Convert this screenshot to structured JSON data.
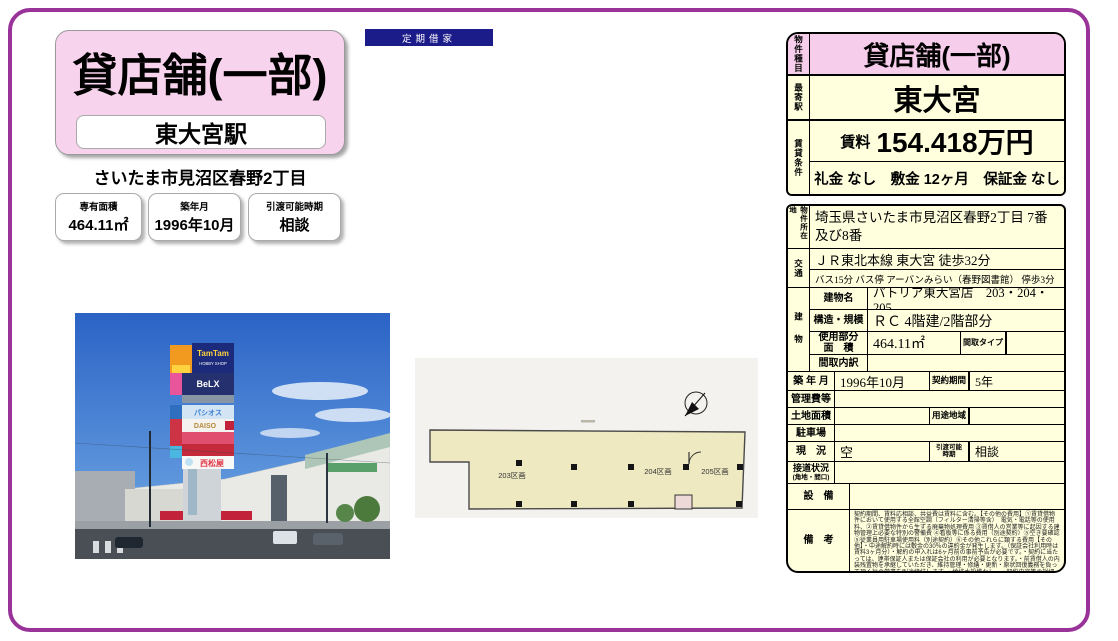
{
  "badge": {
    "label": "定期借家"
  },
  "title_card": {
    "title": "貸店舗(一部)",
    "station": "東大宮駅",
    "address": "さいたま市見沼区春野2丁目"
  },
  "info_boxes": {
    "area_label": "専有面積",
    "area_value": "464.11㎡",
    "built_label": "築年月",
    "built_value": "1996年10月",
    "delivery_label": "引渡可能時期",
    "delivery_value": "相談"
  },
  "photo_signs": {
    "tamtam": "TamTam",
    "hobby": "HOBBY SHOP",
    "belx": "BeLX",
    "pasios": "パシオス",
    "daiso": "DAISO",
    "nishimatsuya": "西松屋"
  },
  "floor_plan": {
    "unit_203": "203区画",
    "unit_204": "204区画",
    "unit_205": "205区画"
  },
  "summary": {
    "type_label": "物件種目",
    "type_value": "貸店舗(一部)",
    "station_label": "最寄駅",
    "station_value": "東大宮",
    "terms_label": "賃貸条件",
    "rent_label": "賃料",
    "rent_value": "154.418万円",
    "fees": "礼金 なし　敷金 12ヶ月　保証金 なし"
  },
  "details": {
    "location_label": "物件所在地",
    "location_value": "埼玉県さいたま市見沼区春野2丁目 7番及び8番",
    "access_label": "交通",
    "access_line1": "ＪＲ東北本線 東大宮 徒歩32分",
    "access_line2": "バス15分 バス停 アーバンみらい（春野図書館） 停歩3分",
    "building_label": "建物",
    "building_name_label": "建物名",
    "building_name_value": "パトリア東大宮店　203・204・205",
    "structure_label": "構造・規模",
    "structure_value": "ＲＣ 4階建/2階部分",
    "used_area_label1": "使用部分",
    "used_area_label2": "面　積",
    "used_area_value": "464.11㎡",
    "madori_type_label": "間取タイプ",
    "madori_detail_label": "間取内訳",
    "built_label": "築 年 月",
    "built_value": "1996年10月",
    "contract_label": "契約期間",
    "contract_value": "5年",
    "kanrihi_label": "管理費等",
    "land_label": "土地面積",
    "yoto_label": "用途地域",
    "parking_label": "駐車場",
    "status_label": "現　況",
    "status_value": "空",
    "delivery_label1": "引渡可能",
    "delivery_label2": "時期",
    "delivery_value": "相談",
    "setsudo_label1": "接道状況",
    "setsudo_label2": "(角地・間口)",
    "equipment_label": "設　備",
    "remarks_label": "備　考",
    "remarks_value": "契約期間、賃料応相談、共益費は賃料に含む。【その他の費用】①賃貸借物件において使用する全館空調（フィルター清掃等含）　電気・電話等の使用料、②賃貸借物件から生ずる廃棄物処理費用 ③賃借人の営業等に起因する建物管理上必要な特別の警備費 ④看板等に係る費用（別途契約）⑤空き要確認 ⑤従業員用駐車場使用料（別途契約）⑥その他これらに類する費用【その他】・中途解約時には敷金の30％の違約金が発生します。（保証会社利用時は賃料3ヶ月分）・解約の申入れは6ヶ月前の事前予告が必要です。・契約に当たっては、連帯保証人または保証会社の利用が必要となります。・前賃借人の内装残置物を承継していただき、維持管理・修繕・更新・原状回復義務を負って頂く旨の覚書を別途締結します。・給排水設備なし　・契約内容等の詳細は、別途お打ち合せによります。　利用駅1：ＪＲ東北本線 蓮田 徒歩43分　利用駅2：東武野田線 七里 徒歩38分"
  }
}
